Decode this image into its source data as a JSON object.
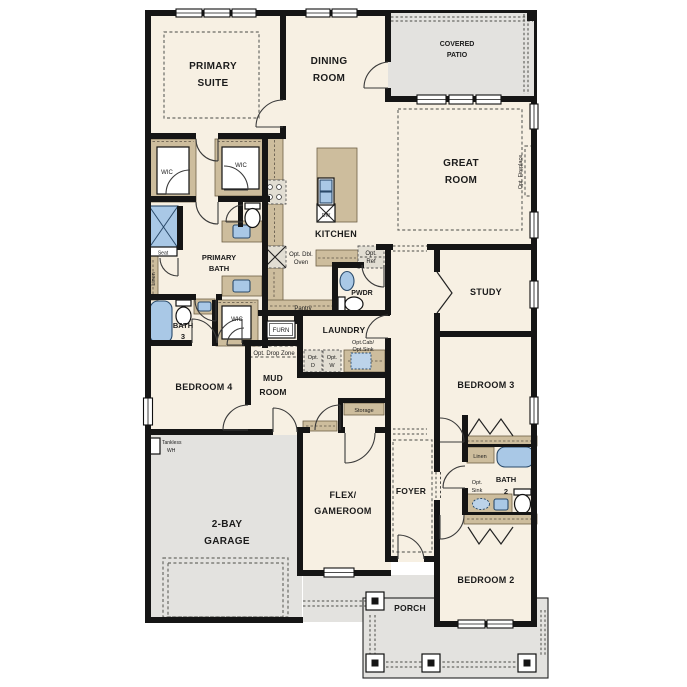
{
  "colors": {
    "floor": "#f7f0e3",
    "exterior": "#e3e2df",
    "wall": "#151515",
    "cabinet": "#cdbd9d",
    "fixture_blue": "#a9c8e6",
    "text": "#1b1b1b"
  },
  "labels": {
    "primary_suite": [
      "PRIMARY",
      "SUITE"
    ],
    "dining_room": [
      "DINING",
      "ROOM"
    ],
    "covered_patio": [
      "COVERED",
      "PATIO"
    ],
    "great_room": [
      "GREAT",
      "ROOM"
    ],
    "opt_fireplace": [
      "Opt. Fireplace"
    ],
    "wic_primary_left": [
      "WIC"
    ],
    "wic_primary_right": [
      "WIC"
    ],
    "kitchen": [
      "KITCHEN"
    ],
    "dw": [
      "DW"
    ],
    "opt_dbl_oven": [
      "Opt. Dbl.",
      "Oven"
    ],
    "opt_ref": [
      "Opt.",
      "Ref"
    ],
    "pantry": [
      "Pantry"
    ],
    "pwdr": [
      "PWDR"
    ],
    "primary_bath": [
      "PRIMARY",
      "BATH"
    ],
    "seat": [
      "Seat"
    ],
    "linen_primary": [
      "Linen"
    ],
    "bath_3": [
      "BATH",
      "3"
    ],
    "wic_hall": [
      "WIC"
    ],
    "furn": [
      "FURN"
    ],
    "laundry": [
      "LAUNDRY"
    ],
    "opt_cab_sink": [
      "Opt.Cab/",
      "Opt.Sink"
    ],
    "opt_d": [
      "Opt.",
      "D"
    ],
    "opt_w": [
      "Opt.",
      "W"
    ],
    "opt_drop_zone": [
      "Opt. Drop Zone"
    ],
    "bedroom_4": [
      "BEDROOM 4"
    ],
    "mud_room": [
      "MUD",
      "ROOM"
    ],
    "study": [
      "STUDY"
    ],
    "bedroom_3": [
      "BEDROOM 3"
    ],
    "tankless_wh": [
      "Tankless",
      "WH"
    ],
    "garage": [
      "2-BAY",
      "GARAGE"
    ],
    "flex_gameroom": [
      "FLEX/",
      "GAMEROOM"
    ],
    "foyer": [
      "FOYER"
    ],
    "storage": [
      "Storage"
    ],
    "linen_bath2": [
      "Linen"
    ],
    "opt_sink": [
      "Opt.",
      "Sink"
    ],
    "bath_2": [
      "BATH",
      "2"
    ],
    "bedroom_2": [
      "BEDROOM 2"
    ],
    "porch": [
      "PORCH"
    ]
  }
}
